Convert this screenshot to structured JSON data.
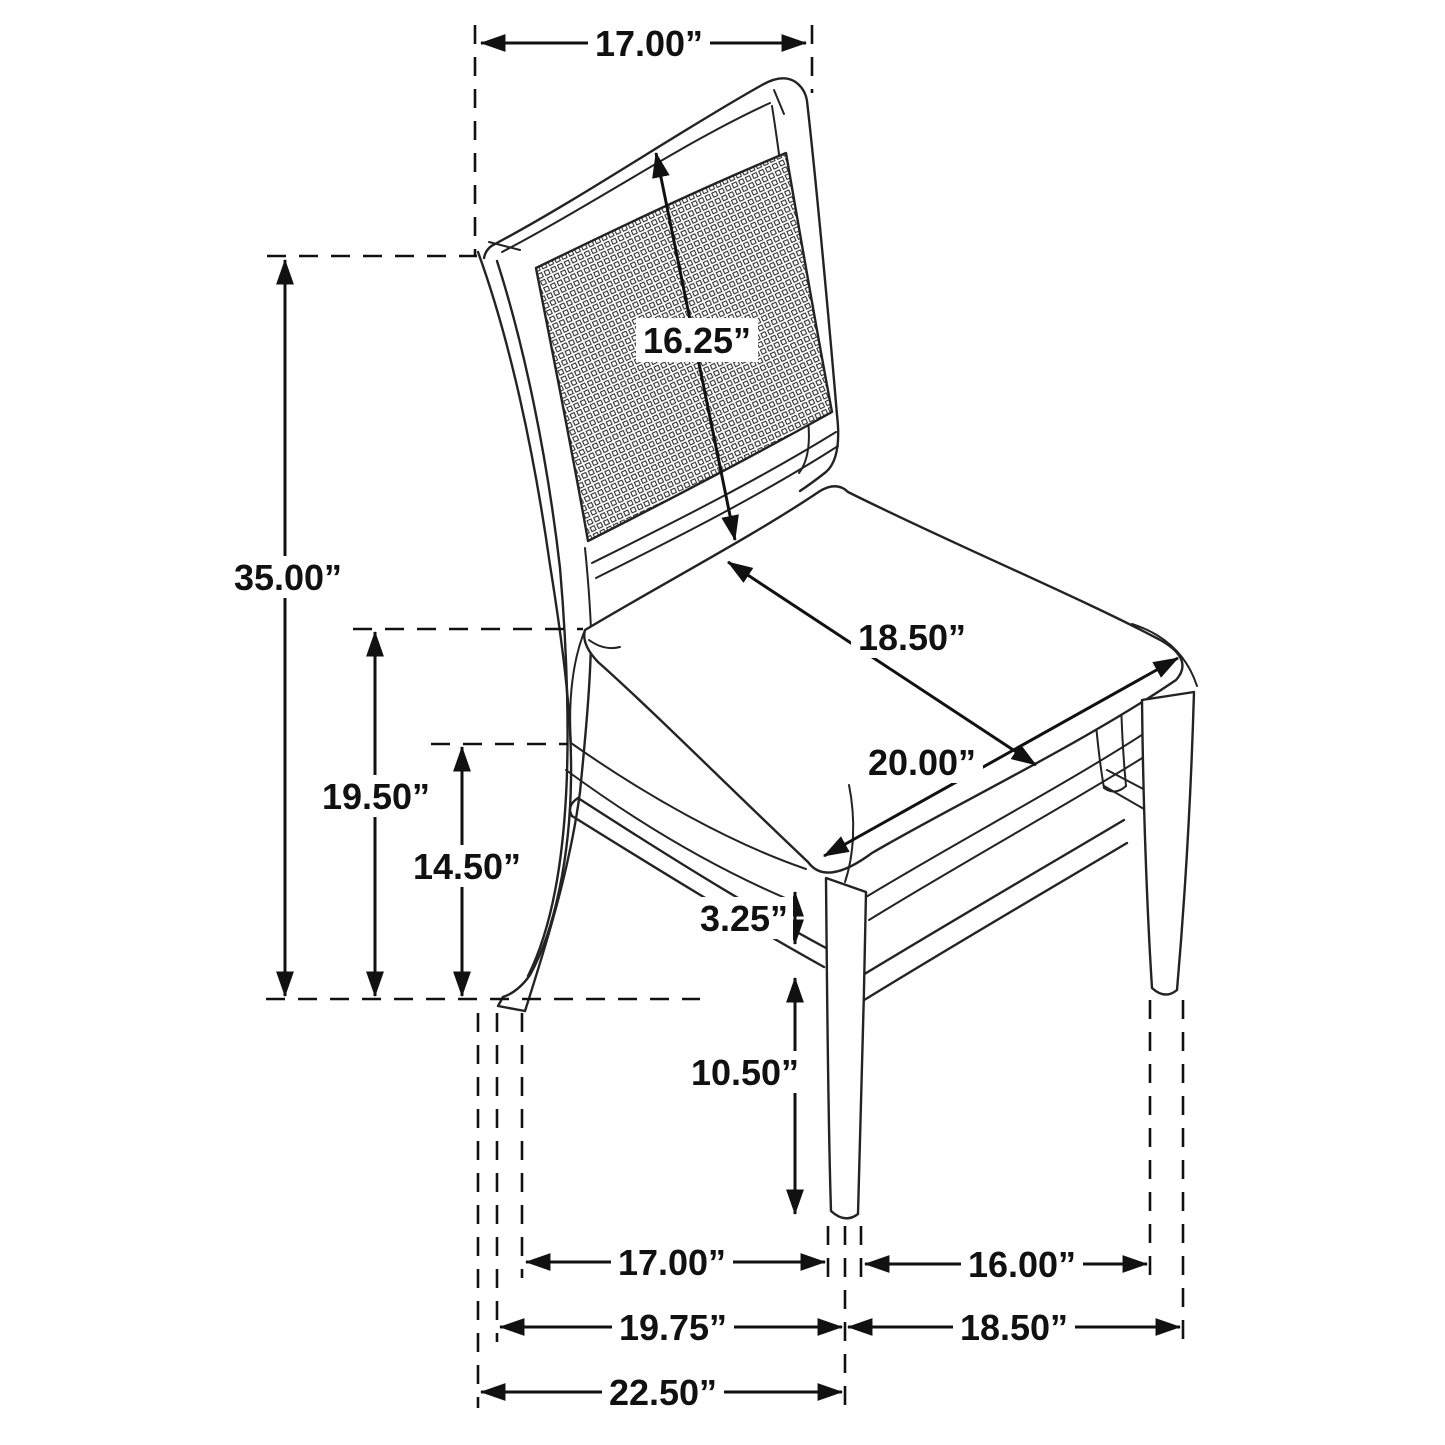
{
  "diagram": {
    "subject": "dining side chair with cane back and upholstered seat",
    "dims": {
      "back_width": "17.00”",
      "overall_height": "35.00”",
      "seat_height": "19.50”",
      "seat_frame_height": "14.50”",
      "back_panel_diagonal": "16.25”",
      "seat_depth": "18.50”",
      "seat_width": "20.00”",
      "apron_to_stretcher": "3.25”",
      "stretcher_to_floor": "10.50”",
      "rear_to_front_leg_inner": "17.00”",
      "rear_to_front_leg_mid": "19.75”",
      "overall_depth": "22.50”",
      "front_legs_inner": "16.00”",
      "front_legs_outer": "18.50”"
    }
  }
}
